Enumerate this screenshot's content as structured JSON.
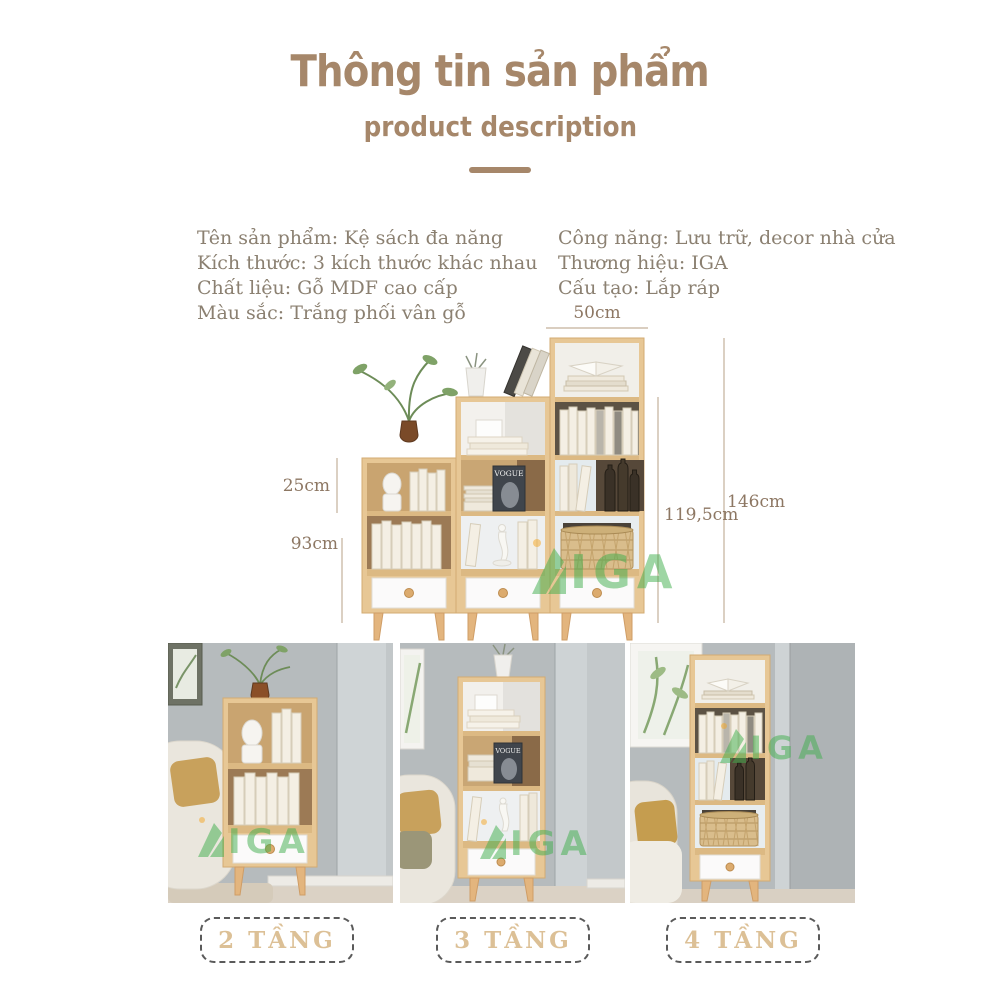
{
  "header": {
    "title": "Thông tin sản phẩm",
    "subtitle": "product description",
    "accent_color": "#a6876a"
  },
  "specs": {
    "text_color": "#8b8071",
    "left": [
      "Tên sản phẩm: Kệ sách đa năng",
      "Kích thước: 3 kích thước khác nhau",
      "Chất liệu: Gỗ MDF cao cấp",
      "Màu sắc: Trắng phối vân gỗ"
    ],
    "right": [
      "Công năng: Lưu trữ, decor nhà cửa",
      "Thương hiệu: IGA",
      "Cấu tạo: Lắp ráp"
    ]
  },
  "figure": {
    "dimensions": {
      "top_width": "50cm",
      "tier_height": "25cm",
      "small_height": "93cm",
      "medium_height": "119,5cm",
      "large_height": "146cm"
    },
    "magazine_title": "VOGUE",
    "wood_color": "#e7c795",
    "line_color": "#c3b19b",
    "dimension_text_color": "#8d7763"
  },
  "watermark": {
    "text": "IGA",
    "color": "#3fae4c"
  },
  "variants": [
    {
      "label": "2 TẦNG"
    },
    {
      "label": "3 TẦNG"
    },
    {
      "label": "4 TẦNG"
    }
  ],
  "variant_label_color": "#dcc096"
}
